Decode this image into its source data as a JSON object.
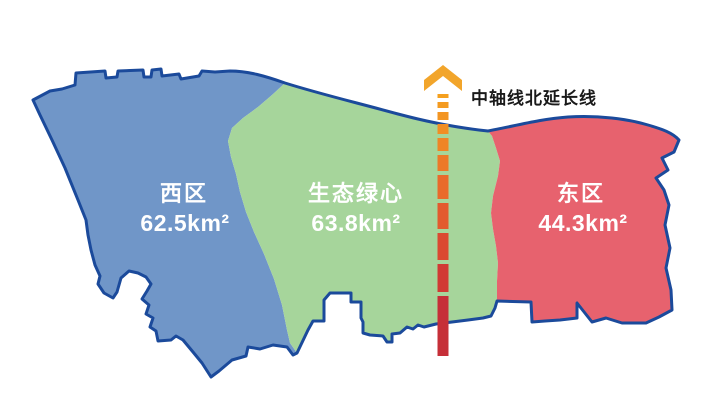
{
  "map": {
    "regions": [
      {
        "name": "西区",
        "area": "62.5km²",
        "fill": "#7096C8"
      },
      {
        "name": "生态绿心",
        "area": "63.8km²",
        "fill": "#A6D59B"
      },
      {
        "name": "东区",
        "area": "44.3km²",
        "fill": "#E7626E"
      }
    ],
    "outline_color": "#1B4A9B",
    "label_text_color": "#FFFFFF"
  },
  "axis": {
    "label": "中轴线北延长线",
    "label_color": "#1A1A1A",
    "arrow_color": "#F2A52B",
    "segment_colors": [
      "#F5A01E",
      "#F49B20",
      "#F39522",
      "#F18E24",
      "#EF8526",
      "#EC7928",
      "#E96A2B",
      "#E35A2E",
      "#DB4931",
      "#D13A34",
      "#C62F38"
    ]
  }
}
